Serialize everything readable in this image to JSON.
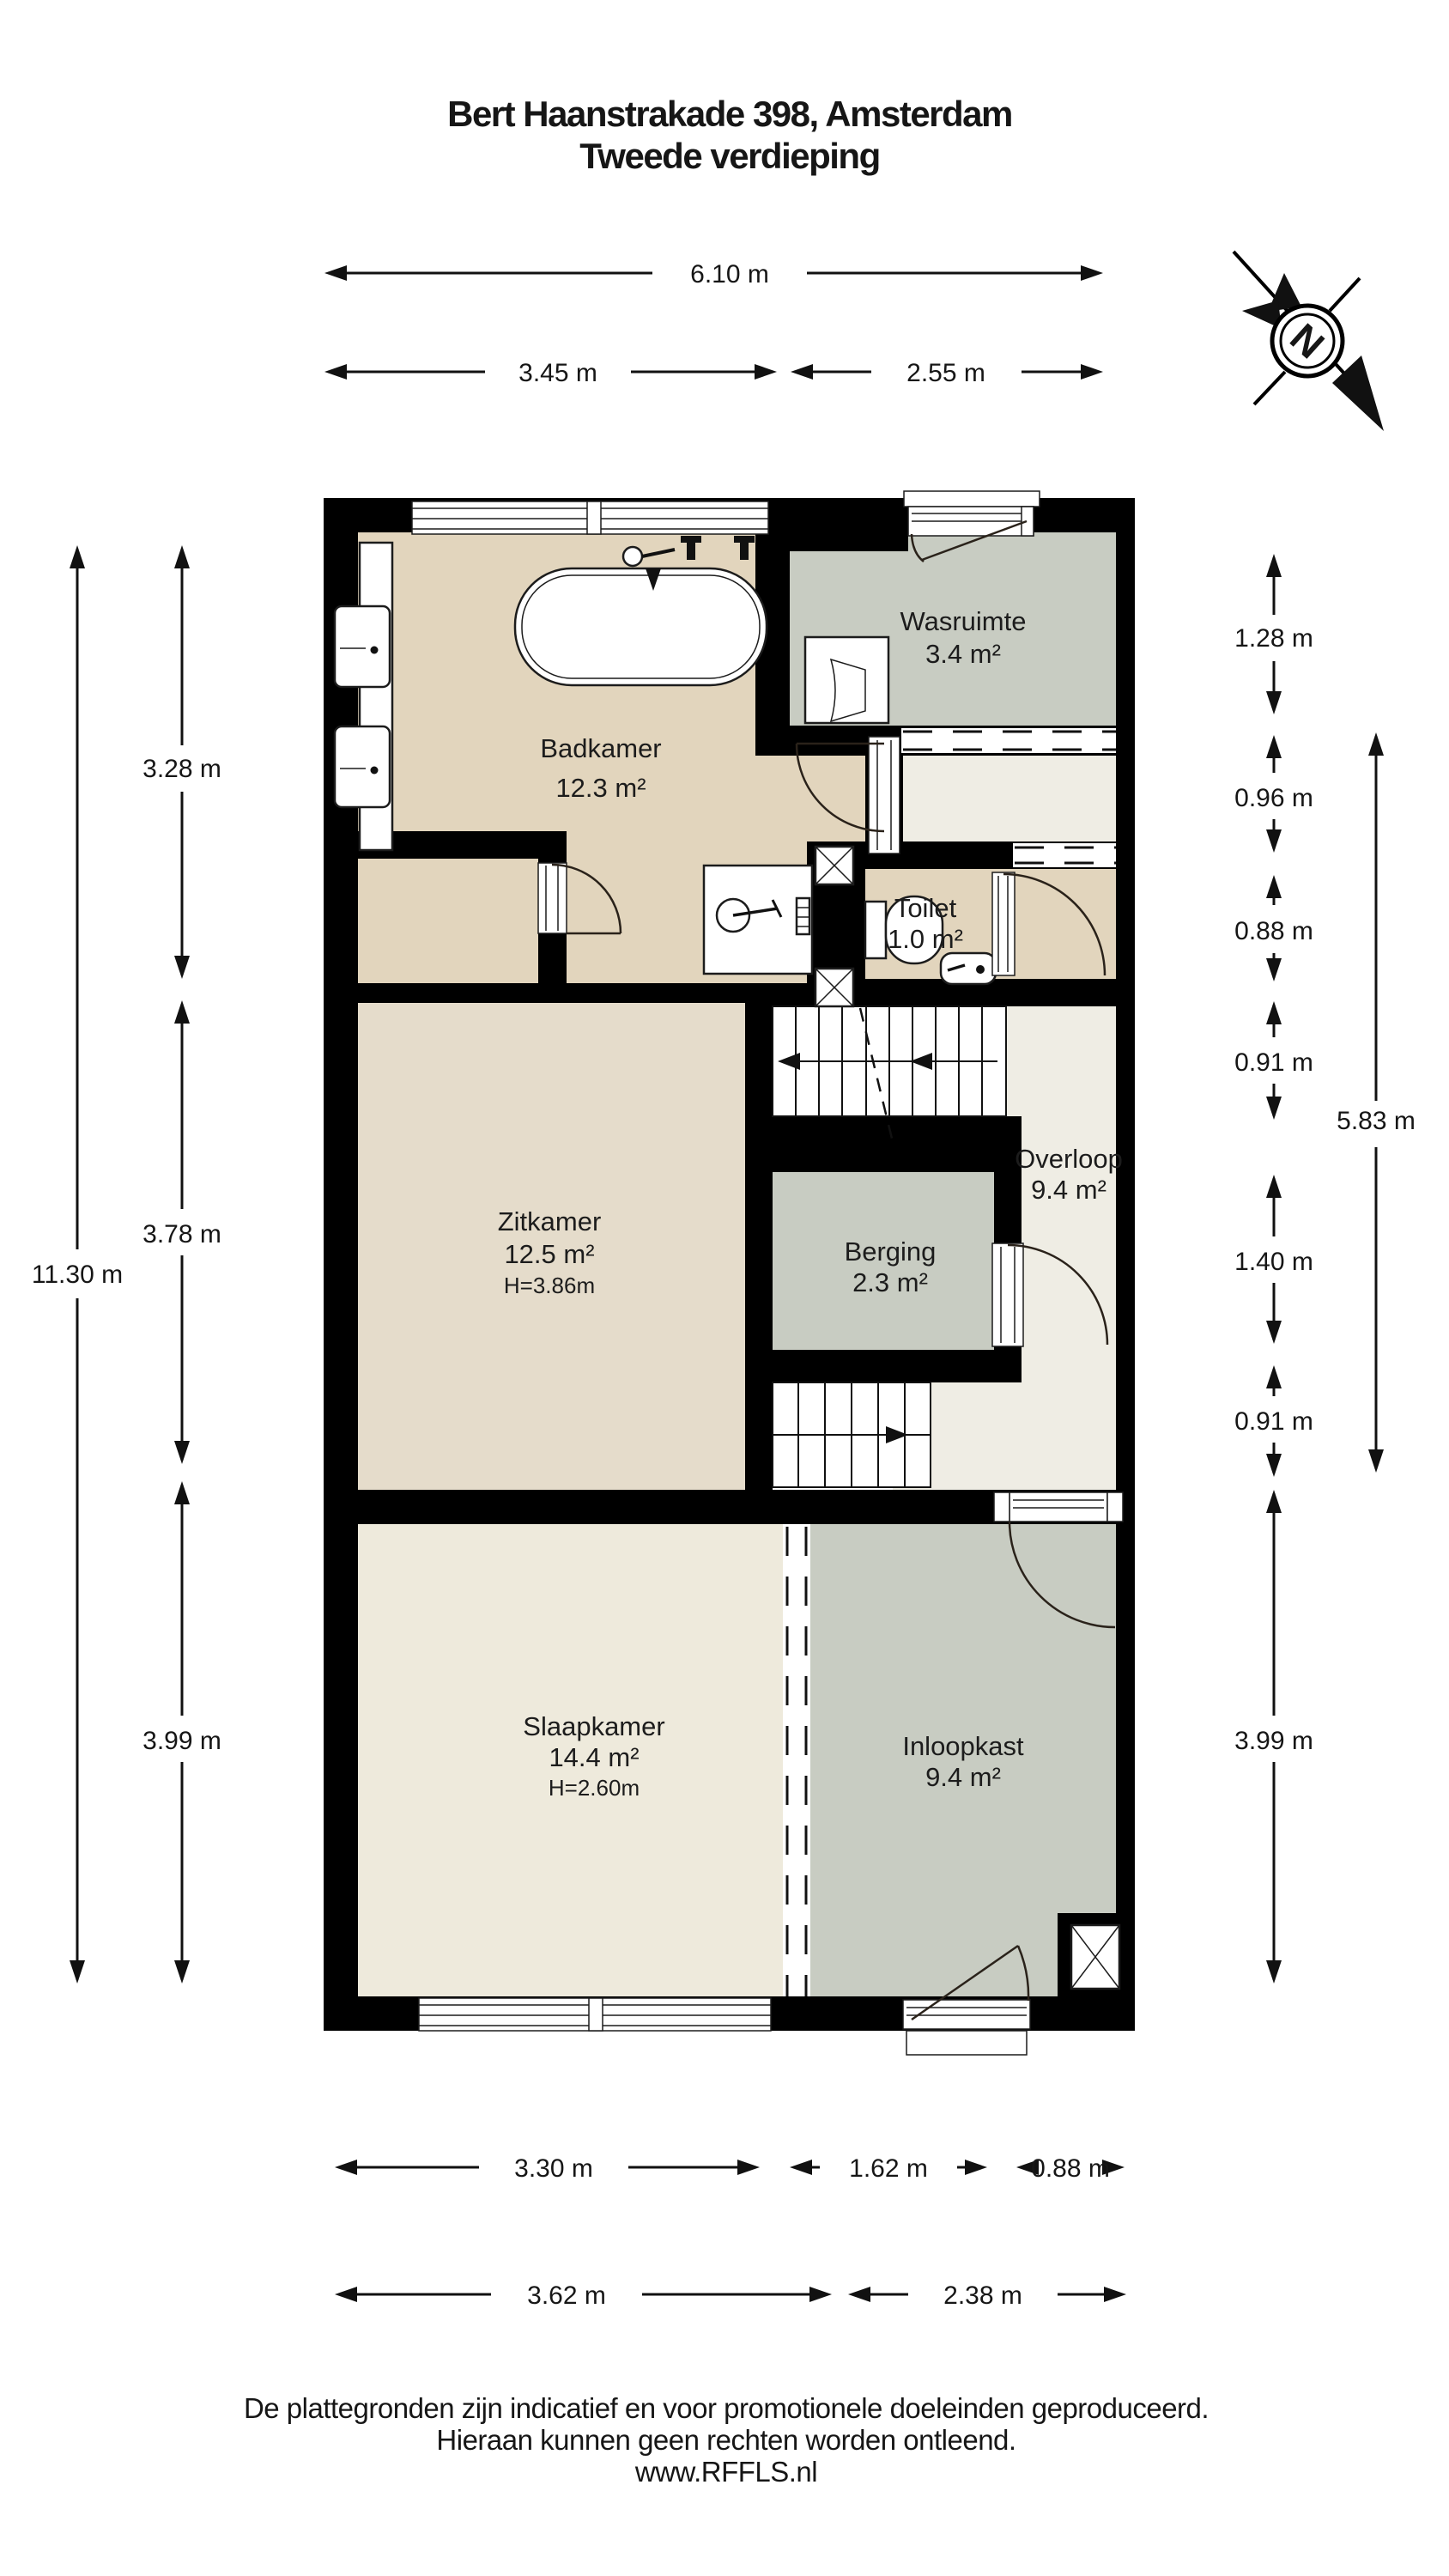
{
  "title": {
    "line1": "Bert Haanstrakade 398, Amsterdam",
    "line2": "Tweede verdieping"
  },
  "compass": {
    "letter": "N"
  },
  "rooms": {
    "badkamer": {
      "name": "Badkamer",
      "area": "12.3 m²"
    },
    "wasruimte": {
      "name": "Wasruimte",
      "area": "3.4 m²"
    },
    "toilet": {
      "name": "Toilet",
      "area": "1.0 m²"
    },
    "overloop": {
      "name": "Overloop",
      "area": "9.4 m²"
    },
    "berging": {
      "name": "Berging",
      "area": "2.3 m²"
    },
    "zitkamer": {
      "name": "Zitkamer",
      "area": "12.5 m²",
      "ceiling": "H=3.86m"
    },
    "slaapkamer": {
      "name": "Slaapkamer",
      "area": "14.4 m²",
      "ceiling": "H=2.60m"
    },
    "inloopkast": {
      "name": "Inloopkast",
      "area": "9.4 m²"
    }
  },
  "dimensions": {
    "top": [
      {
        "label": "6.10 m"
      },
      {
        "label": "3.45 m"
      },
      {
        "label": "2.55 m"
      }
    ],
    "bottom1": [
      {
        "label": "3.30 m"
      },
      {
        "label": "1.62 m"
      },
      {
        "label": "0.88 m"
      }
    ],
    "bottom2": [
      {
        "label": "3.62 m"
      },
      {
        "label": "2.38 m"
      }
    ],
    "left": [
      {
        "label": "11.30 m"
      },
      {
        "label": "3.28 m"
      },
      {
        "label": "3.78 m"
      },
      {
        "label": "3.99 m"
      }
    ],
    "right": [
      {
        "label": "1.28 m"
      },
      {
        "label": "0.96 m"
      },
      {
        "label": "0.88 m"
      },
      {
        "label": "0.91 m"
      },
      {
        "label": "1.40 m"
      },
      {
        "label": "0.91 m"
      },
      {
        "label": "3.99 m"
      },
      {
        "label": "5.83 m"
      }
    ]
  },
  "footer": {
    "line1": "De plattegronden zijn indicatief en voor promotionele doeleinden geproduceerd.",
    "line2": "Hieraan kunnen geen rechten worden ontleend.",
    "line3": "www.RFFLS.nl"
  },
  "colors": {
    "wall": "#000000",
    "room_beige": "#e2d5bd",
    "room_light_beige": "#e5dccb",
    "room_cream": "#eeeadc",
    "room_gray": "#c8ccc2",
    "room_offwhite": "#efede4"
  }
}
